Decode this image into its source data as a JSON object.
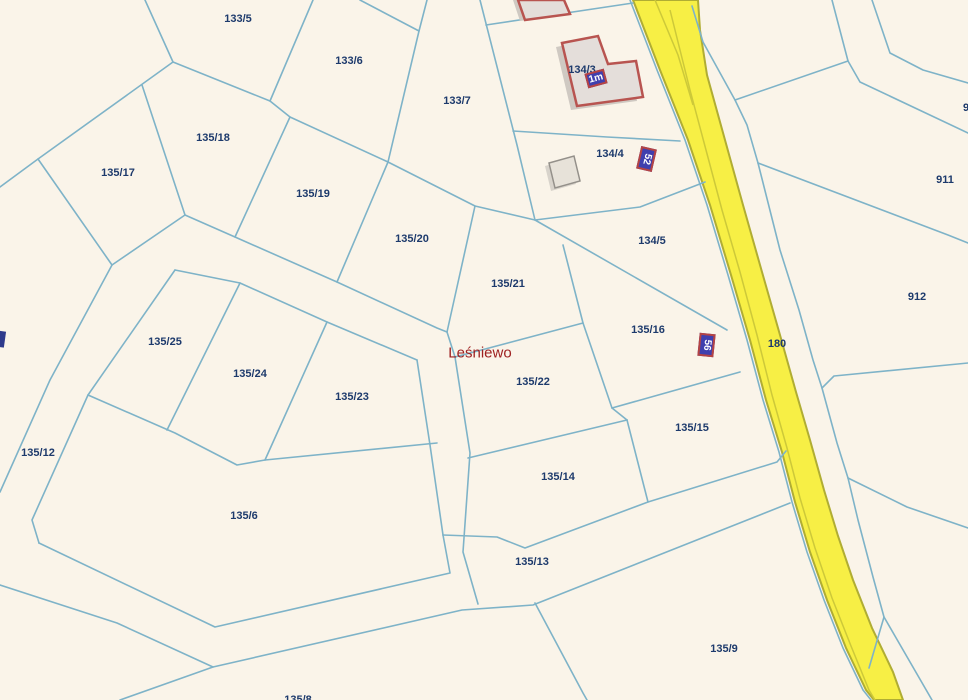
{
  "map": {
    "place_labels": [
      {
        "text": "Leśniewo",
        "x": 480,
        "y": 353
      }
    ],
    "parcel_labels": [
      {
        "text": "133/5",
        "x": 238,
        "y": 19
      },
      {
        "text": "133/6",
        "x": 349,
        "y": 61
      },
      {
        "text": "133/7",
        "x": 457,
        "y": 101
      },
      {
        "text": "135/18",
        "x": 213,
        "y": 138
      },
      {
        "text": "135/17",
        "x": 118,
        "y": 173
      },
      {
        "text": "135/19",
        "x": 313,
        "y": 194
      },
      {
        "text": "135/20",
        "x": 412,
        "y": 239
      },
      {
        "text": "134/3",
        "x": 582,
        "y": 70
      },
      {
        "text": "134/4",
        "x": 610,
        "y": 154
      },
      {
        "text": "134/5",
        "x": 652,
        "y": 241
      },
      {
        "text": "135/21",
        "x": 508,
        "y": 284
      },
      {
        "text": "135/16",
        "x": 648,
        "y": 330
      },
      {
        "text": "180",
        "x": 777,
        "y": 344
      },
      {
        "text": "135/25",
        "x": 165,
        "y": 342
      },
      {
        "text": "135/24",
        "x": 250,
        "y": 374
      },
      {
        "text": "135/23",
        "x": 352,
        "y": 397
      },
      {
        "text": "135/22",
        "x": 533,
        "y": 382
      },
      {
        "text": "135/12",
        "x": 38,
        "y": 453
      },
      {
        "text": "135/15",
        "x": 692,
        "y": 428
      },
      {
        "text": "135/14",
        "x": 558,
        "y": 477
      },
      {
        "text": "135/6",
        "x": 244,
        "y": 516
      },
      {
        "text": "135/13",
        "x": 532,
        "y": 562
      },
      {
        "text": "135/9",
        "x": 724,
        "y": 649
      },
      {
        "text": "135/8",
        "x": 298,
        "y": 700
      },
      {
        "text": "911",
        "x": 945,
        "y": 180
      },
      {
        "text": "912",
        "x": 917,
        "y": 297
      },
      {
        "text": "9",
        "x": 966,
        "y": 108
      }
    ],
    "address_markers": [
      {
        "text": "1m",
        "x": 596,
        "y": 78,
        "rotation": -15,
        "w": 20,
        "h": 15
      },
      {
        "text": "52",
        "x": 646,
        "y": 159,
        "rotation": 103,
        "w": 23,
        "h": 16
      },
      {
        "text": "56",
        "x": 706,
        "y": 345,
        "rotation": 96,
        "w": 23,
        "h": 16
      }
    ],
    "colors": {
      "background": "#faf4e9",
      "parcel_line": "#7eb3c8",
      "road_fill": "#f7ef45",
      "road_casing": "#b0ad33",
      "road_centerline": "#cdc939",
      "parcel_label_text": "#1d3a6c",
      "place_label_text": "#9e2020",
      "building_stroke": "#b85450",
      "building_fill": "#e4deda",
      "building_shadow": "#cfc9c2",
      "gray_building_stroke": "#94908a",
      "gray_building_fill": "#e7e2d9",
      "marker_fill": "#3f3fae",
      "marker_border": "#b54343",
      "marker_text": "#ffffff"
    }
  }
}
